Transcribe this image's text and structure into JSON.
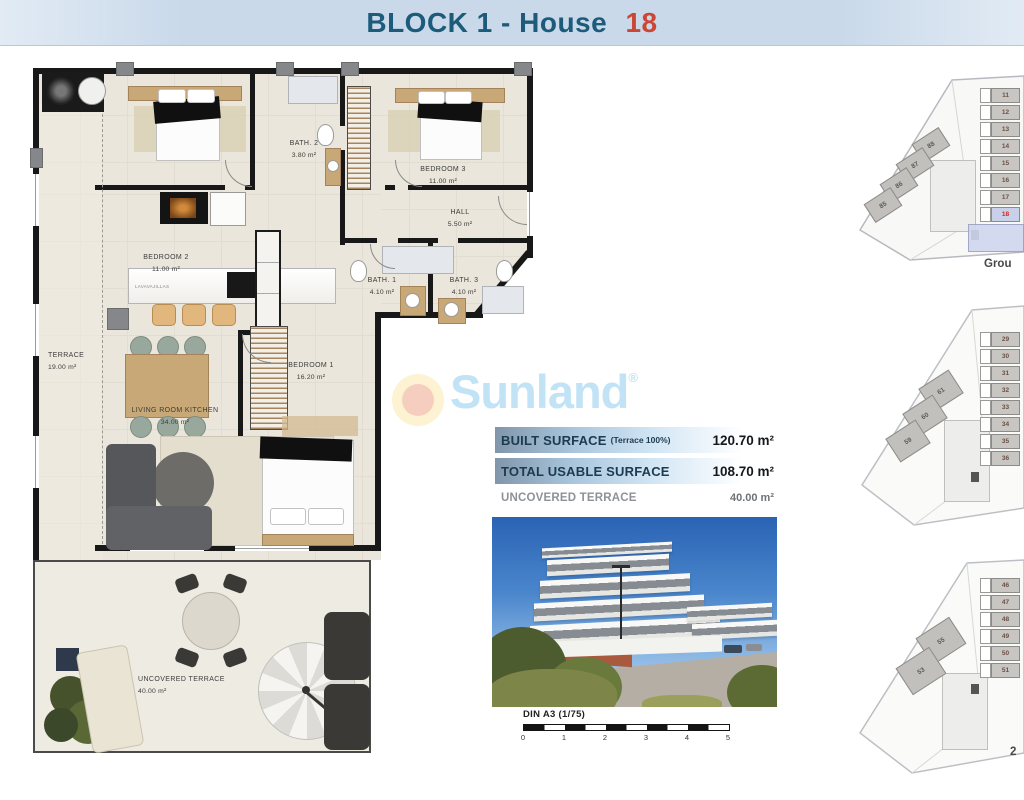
{
  "header": {
    "title_main": "BLOCK 1 - House",
    "title_number": "18"
  },
  "floorplan": {
    "rooms": {
      "terrace": {
        "name": "TERRACE",
        "area": "19.00 m²"
      },
      "bedroom2": {
        "name": "BEDROOM 2",
        "area": "11.00 m²"
      },
      "bath2": {
        "name": "BATH. 2",
        "area": "3.80 m²"
      },
      "bedroom3": {
        "name": "BEDROOM 3",
        "area": "11.00 m²"
      },
      "hall": {
        "name": "HALL",
        "area": "5.50 m²"
      },
      "bath1": {
        "name": "BATH. 1",
        "area": "4.10 m²"
      },
      "bath3": {
        "name": "BATH. 3",
        "area": "4.10 m²"
      },
      "bedroom1": {
        "name": "BEDROOM 1",
        "area": "16.20 m²"
      },
      "living": {
        "name": "LIVING ROOM KITCHEN",
        "area": "34.00 m²"
      },
      "uncovered": {
        "name": "UNCOVERED TERRACE",
        "area": "40.00 m²"
      }
    },
    "kitchen_appliance": "LAVAVAJILLAS"
  },
  "watermark": {
    "brand": "Sunland",
    "registered": "®"
  },
  "surface_table": {
    "rows": [
      {
        "label": "BUILT SURFACE",
        "sublabel": "(Terrace 100%)",
        "value": "120.70 m²"
      },
      {
        "label": "TOTAL USABLE SURFACE",
        "sublabel": "",
        "value": "108.70 m²"
      },
      {
        "label": "UNCOVERED TERRACE",
        "sublabel": "",
        "value": "40.00 m²"
      }
    ]
  },
  "scalebar": {
    "label": "DIN A3 (1/75)",
    "ticks": [
      "0",
      "1",
      "2",
      "3",
      "4",
      "5"
    ]
  },
  "site_plans": [
    {
      "caption": "Grou",
      "column_units": [
        "11",
        "12",
        "13",
        "14",
        "15",
        "16",
        "17",
        "18"
      ],
      "highlighted_unit": "18",
      "diagonal_units": [
        "88",
        "87",
        "86",
        "85"
      ]
    },
    {
      "caption": "",
      "column_units": [
        "29",
        "30",
        "31",
        "32",
        "33",
        "34",
        "35",
        "36"
      ],
      "highlighted_unit": "",
      "diagonal_units": [
        "61",
        "60",
        "59"
      ]
    },
    {
      "caption": "2",
      "column_units": [
        "46",
        "47",
        "48",
        "49",
        "50",
        "51"
      ],
      "highlighted_unit": "",
      "diagonal_units": [
        "55",
        "53"
      ]
    }
  ],
  "colors": {
    "title_navy": "#1d5b7b",
    "accent_red": "#cc4733",
    "bar_blue": "#a9c6de",
    "highlight_unit": "#c9d1ea",
    "sunland_blue": "#b9e0f4"
  }
}
